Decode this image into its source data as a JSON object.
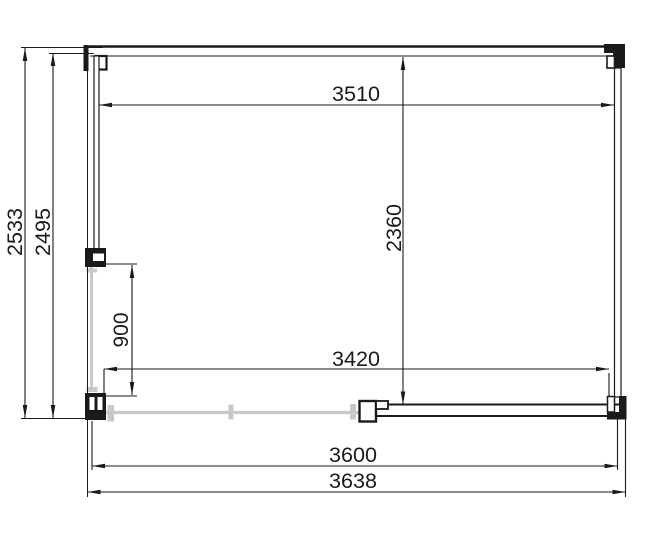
{
  "drawing": {
    "type": "floor-plan",
    "colors": {
      "line": "#1a1a1a",
      "open_wall": "#c8c8c8",
      "background": "#ffffff"
    },
    "dimensions": {
      "inner_width_front": "3510",
      "inner_depth": "2360",
      "overall_depth": "2533",
      "frame_depth": "2495",
      "side_opening": "900",
      "inner_width_back": "3420",
      "frame_width": "3600",
      "overall_width": "3638"
    }
  }
}
